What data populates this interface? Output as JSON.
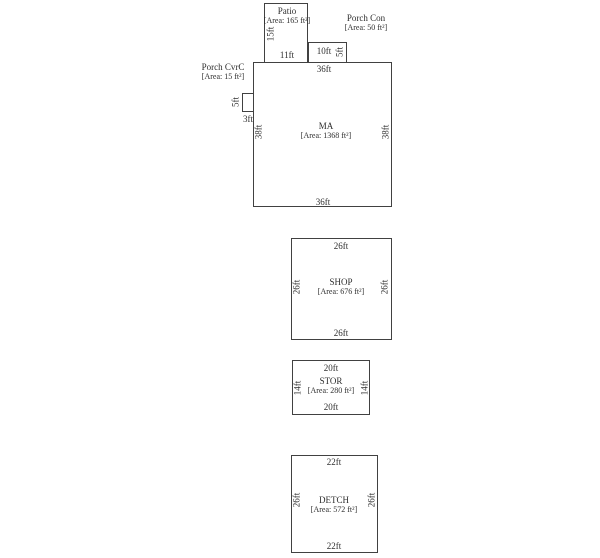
{
  "diagram": {
    "background": "#ffffff",
    "line_color": "#414141",
    "text_color": "#2e2e2e"
  },
  "buildings": {
    "ma": {
      "name": "MA",
      "area": "[Area: 1368 ft²]",
      "dim_top": "36ft",
      "dim_bottom": "36ft",
      "dim_left": "38ft",
      "dim_right": "38ft"
    },
    "patio": {
      "name": "Patio",
      "area": "[Area: 165 ft²]",
      "dim_left": "15ft",
      "dim_bottom": "11ft"
    },
    "porch_con": {
      "name": "Porch Con",
      "area": "[Area: 50 ft²]",
      "dim_top": "10ft",
      "dim_right": "5ft"
    },
    "porch_cvrc": {
      "name": "Porch CvrC",
      "area": "[Area: 15 ft²]",
      "dim_left": "5ft",
      "dim_bottom": "3ft"
    },
    "shop": {
      "name": "SHOP",
      "area": "[Area: 676 ft²]",
      "dim_top": "26ft",
      "dim_bottom": "26ft",
      "dim_left": "26ft",
      "dim_right": "26ft"
    },
    "stor": {
      "name": "STOR",
      "area": "[Area: 280 ft²]",
      "dim_top": "20ft",
      "dim_bottom": "20ft",
      "dim_left": "14ft",
      "dim_right": "14ft"
    },
    "detch": {
      "name": "DETCH",
      "area": "[Area: 572 ft²]",
      "dim_top": "22ft",
      "dim_bottom": "22ft",
      "dim_left": "26ft",
      "dim_right": "26ft"
    }
  }
}
